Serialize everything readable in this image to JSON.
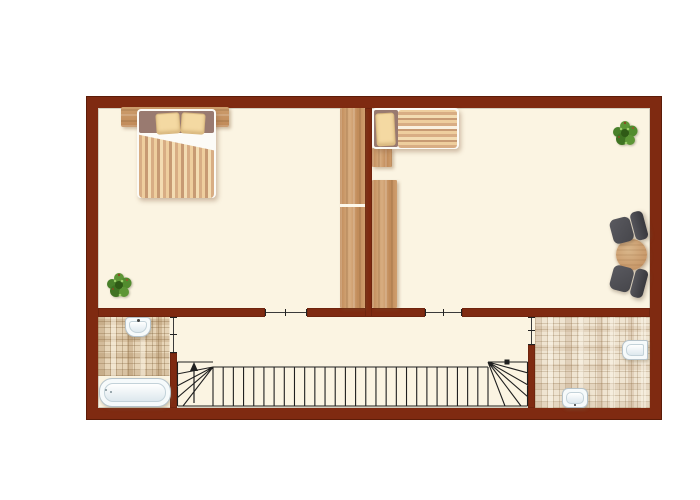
{
  "image": {
    "type": "floor-plan",
    "visible_text": [],
    "description": "upper-floor plan: two bedrooms over two bathrooms with central staircase"
  },
  "palette": {
    "wall": "#7f2a11",
    "wall_dark": "#5c1c08",
    "floor": "#fbf4e2",
    "wood": "#c99a6a",
    "tile_left_bath": "#e7d5b8",
    "tile_right_bath": "#efe4d1",
    "stair_line": "#1f1f1f",
    "chair": "#46464b",
    "table": "#c9996a",
    "plant_green": "#4e8a2a",
    "fixture_white": "#f6fafb",
    "pillow": "#f4d9a2",
    "bed_head_fabric": "#997a70"
  },
  "rooms": [
    {
      "id": "bedroom-left",
      "furniture": [
        "double-bed",
        "tall-wardrobe",
        "potted-plant"
      ]
    },
    {
      "id": "bedroom-right",
      "furniture": [
        "single-bed",
        "wardrobe-upper",
        "wardrobe-lower",
        "potted-plant",
        "chair",
        "round-table",
        "chair"
      ]
    },
    {
      "id": "bathroom-left",
      "furniture": [
        "wash-basin",
        "bathtub"
      ],
      "floor": "mosaic-tile"
    },
    {
      "id": "bathroom-right",
      "furniture": [
        "wash-basin",
        "toilet"
      ],
      "floor": "mosaic-tile"
    },
    {
      "id": "landing",
      "furniture": [
        "staircase"
      ]
    }
  ],
  "stairs": {
    "tread_lines": 28,
    "arrow_direction": "up",
    "winder_left": true,
    "winder_right": true,
    "newel_marker": true
  },
  "doors": [
    {
      "id": "door-bedroom-left",
      "wall": "south"
    },
    {
      "id": "door-bedroom-right",
      "wall": "south"
    },
    {
      "id": "door-bathroom-left",
      "wall": "east"
    },
    {
      "id": "door-bathroom-right",
      "wall": "west"
    }
  ]
}
